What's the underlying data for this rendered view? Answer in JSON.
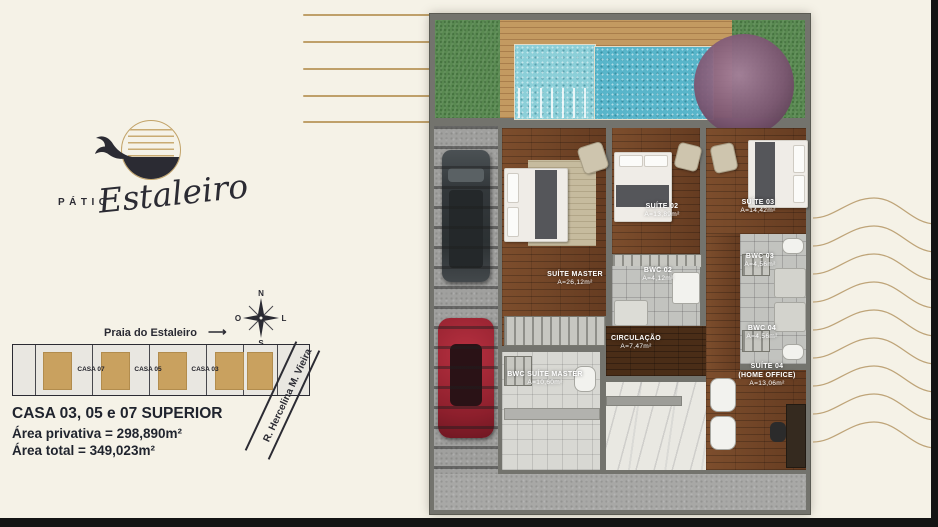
{
  "brand": {
    "word": "PÁTIO",
    "script": "Estaleiro"
  },
  "compass": {
    "north": "N",
    "east": "L",
    "south": "S",
    "west": "O"
  },
  "map": {
    "beach_label": "Praia do Estaleiro",
    "arrow": "⟶",
    "street_label": "R. Hercelina M. Vieira",
    "lots": [
      "CASA 07",
      "CASA 05",
      "CASA 03"
    ]
  },
  "summary": {
    "title": "CASA 03, 05 e 07 SUPERIOR",
    "private_area": "Área privativa = 298,890m²",
    "total_area": "Área total = 349,023m²"
  },
  "floorplan": {
    "rooms": [
      {
        "name": "SUÍTE MASTER",
        "area": "A=26,12m²"
      },
      {
        "name": "SUÍTE 02",
        "area": "A=13,89m²"
      },
      {
        "name": "SUÍTE 03",
        "area": "A=14,42m²"
      },
      {
        "name": "BWC 02",
        "area": "A=4,12m²"
      },
      {
        "name": "BWC 03",
        "area": "A=4,56m²"
      },
      {
        "name": "BWC 04",
        "area": "A=4,56m²"
      },
      {
        "name": "CIRCULAÇÃO",
        "area": "A=7,47m²"
      },
      {
        "name": "BWC SUÍTE MASTER",
        "area": "A=10,60m²"
      },
      {
        "name": "SUÍTE 04",
        "sub": "(HOME OFFICE)",
        "area": "A=13,06m²"
      }
    ]
  },
  "colors": {
    "accent_gold": "#bfa06a",
    "ink": "#26262e",
    "lot_fill": "#c9a15f",
    "wood": "#6e4124",
    "grass": "#5a8a52",
    "pool": "#63bccd",
    "car_red": "#9c2430"
  }
}
